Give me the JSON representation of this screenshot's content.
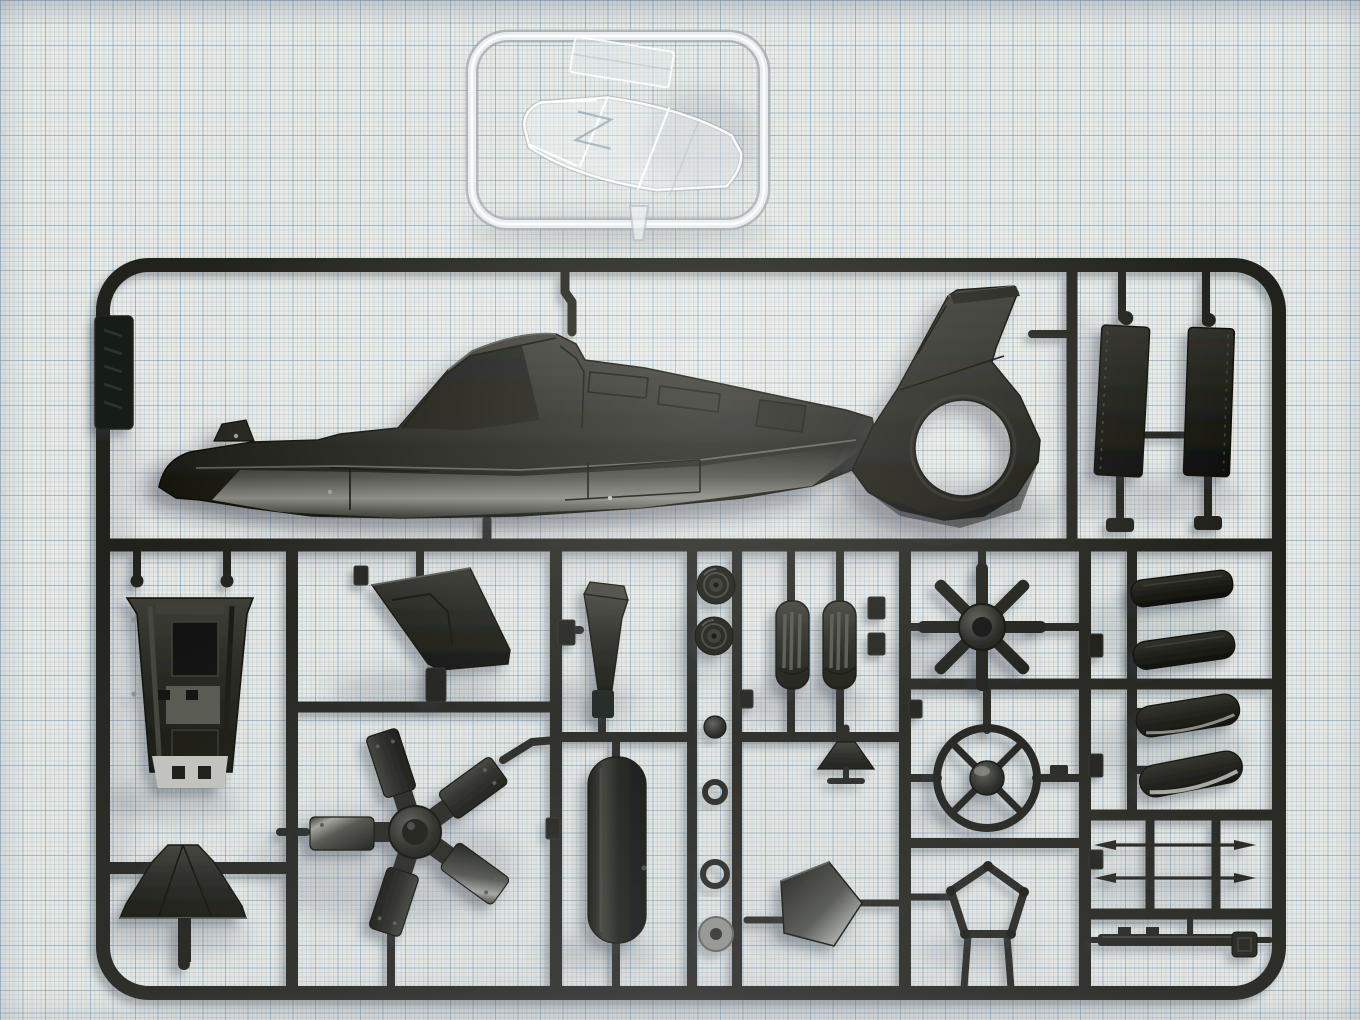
{
  "scene": {
    "type": "photograph",
    "subject": "Plastic scale-model kit sprues photographed on blue millimetre graph paper",
    "aria": "Photo of an injection-moulded model kit: a small clear sprue holding cockpit canopy parts sits above a large dark-grey sprue holding stealth-helicopter parts (fuselage half, fenestron tail, rotor hub, blades, wheels and small fittings), all laid on light graph paper"
  },
  "grid": {
    "minor_px": 4.5,
    "major_every_squares": 5
  },
  "colors": {
    "paper": "#e9eae5",
    "grid_minor": "rgba(125,160,185,0.22)",
    "grid_major": "rgba(99,141,173,0.42)",
    "runner": "#20211a",
    "plastic_dark": "#17180f",
    "plastic_mid": "#24251d",
    "plastic_highlight": "#8e8f87",
    "clear_plastic": "rgba(240,244,245,0.45)",
    "clear_edge": "rgba(255,255,255,0.92)",
    "shadow": "#49505f"
  },
  "sprues": {
    "clear": {
      "label": "clear sprue with transparent parts",
      "parts": {
        "frame": "clear rectangular runner frame",
        "canopy": "transparent cockpit canopy with frame lines",
        "window": "transparent flat window panel",
        "stem": "clear feed stem"
      }
    },
    "main": {
      "label": "dark grey-green helicopter parts sprue",
      "parts": {
        "frame": "rectangular runner frame with internal runners",
        "name_plate": "embossed name-plate tab (lettering illegible)",
        "fuselage": "helicopter fuselage left half with cockpit hump",
        "tail": "tail section with swept fin and fenestron duct opening",
        "panel_left": "rectangular stub-wing panel",
        "panel_right": "rectangular stub-wing panel",
        "cockpit_tub": "tapered cockpit tub with seat and console detail",
        "bay_door": "angled weapon-bay door panel",
        "rotor_hub": "five-arm main-rotor hub with paddle blade roots",
        "bell_fairing": "bell-shaped rotor-mast fairing",
        "fin_insert": "tapered tail-fin insert",
        "tank": "long cylindrical tank body",
        "wheel_a": "landing-gear wheel",
        "wheel_b": "landing-gear wheel",
        "strut_a": "ribbed undercarriage strut",
        "strut_b": "ribbed undercarriage strut",
        "hub_fairing": "small trapezoid hub fairing",
        "ball_joint": "round ball joint",
        "ring_small": "small retaining ring",
        "ring_mid": "retaining ring",
        "washer": "light-grey washer with centre hole",
        "cap_plate": "pentagonal rotor-hub cap plate",
        "fan": "eight-blade fenestron fan",
        "spoked_ring": "four-spoke hub ring with domed centre",
        "pentagon_frame": "open pentagonal frame ring",
        "fairing_1": "slanted intake fairing",
        "fairing_2": "slanted intake fairing",
        "fairing_3": "curved glossy cowl panel",
        "fairing_4": "curved glossy cowl panel",
        "probe_1": "thin double-ended pitot probe",
        "probe_2": "thin double-ended pitot probe",
        "skid_rail": "notched skid rail strip",
        "corner_block": "small square fitting block"
      }
    }
  }
}
